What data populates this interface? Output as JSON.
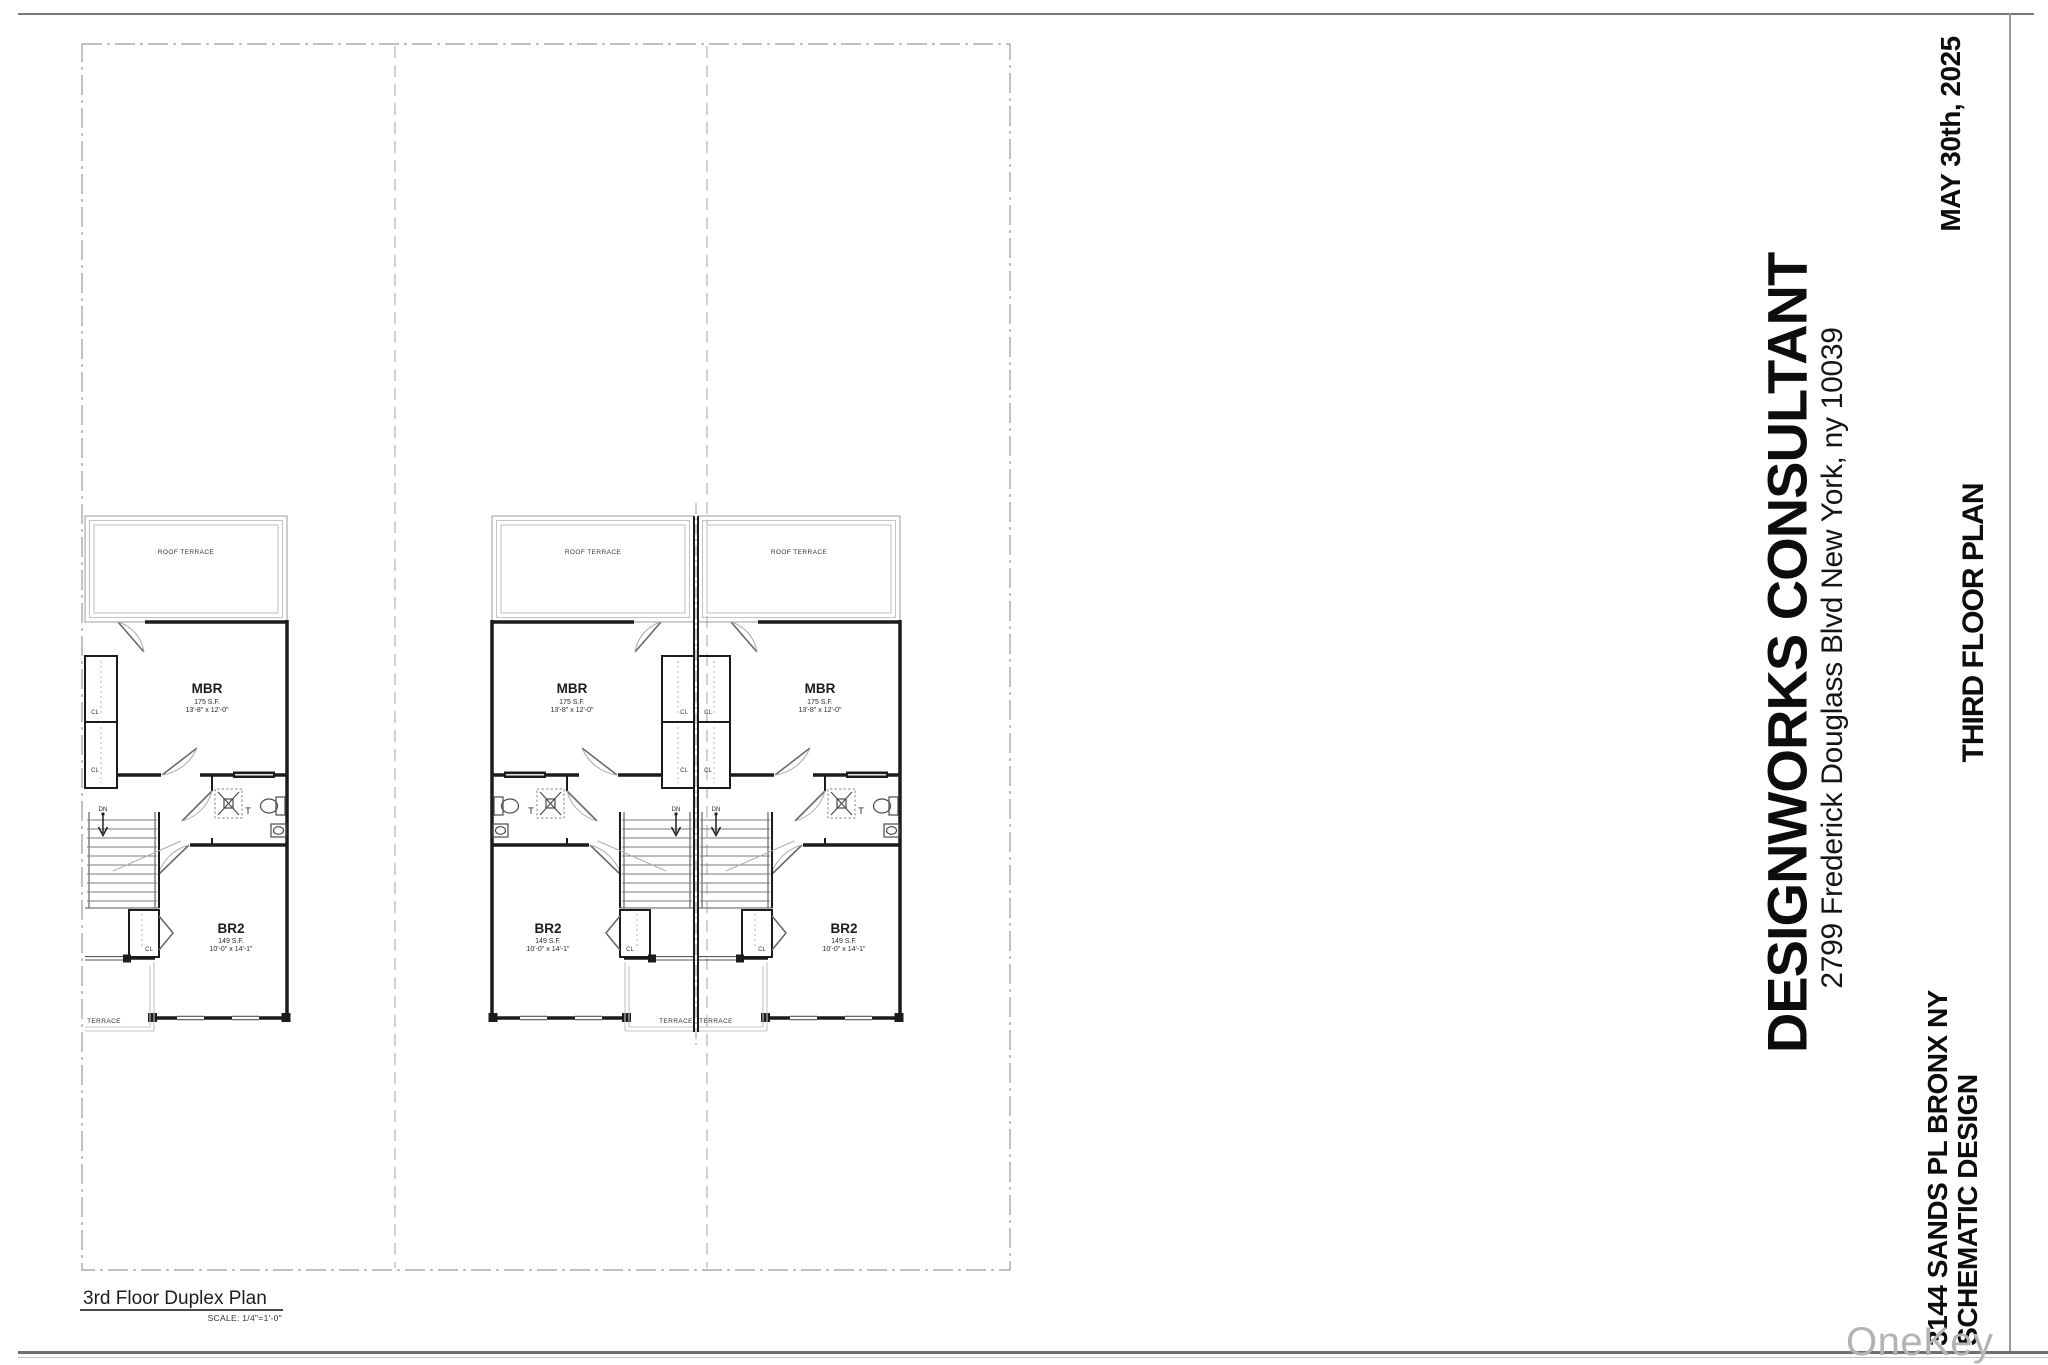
{
  "title_block": {
    "firm": "DESIGNWORKS CONSULTANT",
    "address": "2799 Frederick Douglass Blvd New York, ny 10039",
    "date": "MAY 30th, 2025",
    "sheet_title": "THIRD FLOOR PLAN",
    "project": "3144 SANDS PL BRONX NY",
    "phase": "SCHEMATIC DESIGN"
  },
  "drawing": {
    "title": "3rd Floor Duplex Plan",
    "scale": "SCALE: 1/4\"=1'-0\""
  },
  "plan_labels": {
    "roof_terrace": "ROOF TERRACE",
    "terrace": "TERRACE",
    "mbr": "MBR",
    "mbr_area": "175 S.F.",
    "mbr_dims": "13'-8\" x 12'-0\"",
    "br2": "BR2",
    "br2_area": "149 S.F.",
    "br2_dims": "10'-0\" x 14'-1\"",
    "closet": "CL",
    "toilet": "T",
    "down": "DN"
  },
  "watermark": "OneKey MLS",
  "colors": {
    "wall": "#1c1c1c",
    "light_line": "#c4c4c4",
    "dash_border": "#9a9a9a",
    "watermark": "#b3b3b3"
  }
}
